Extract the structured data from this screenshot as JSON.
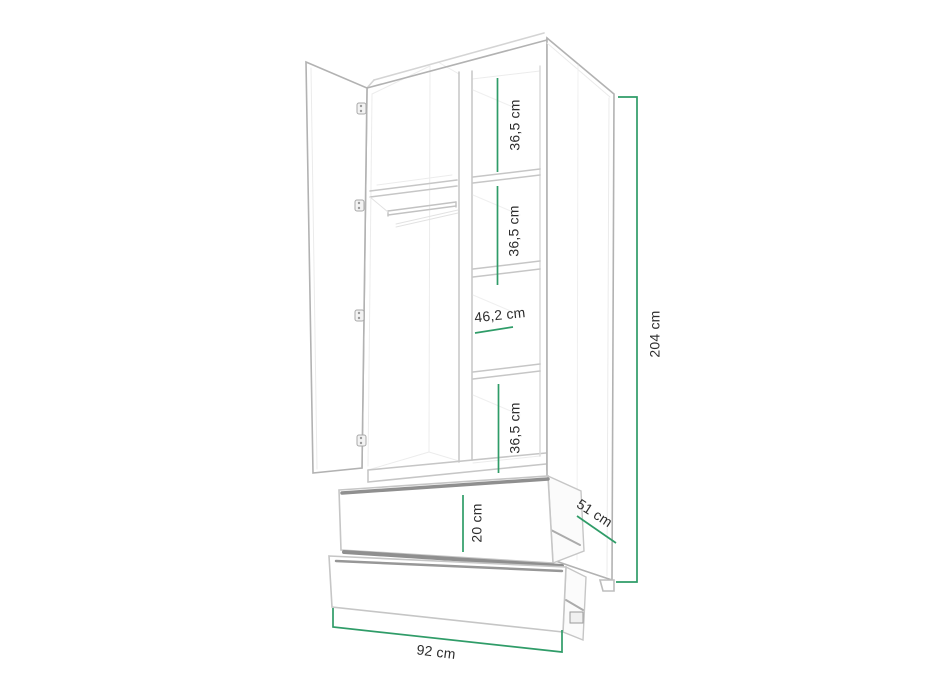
{
  "diagram": {
    "kind": "wardrobe-dimension-drawing",
    "labels": {
      "shelf1": "36,5 cm",
      "shelf2": "36,5 cm",
      "niche_width": "46,2 cm",
      "shelf4": "36,5 cm",
      "drawer_height": "20 cm",
      "depth": "51 cm",
      "total_height": "204 cm",
      "total_width": "92 cm"
    },
    "colors": {
      "dimension": "#2f9c68",
      "outline": "#c6c6c6",
      "outline_dark": "#b2b2b2",
      "faint": "#e9e9e9",
      "shadow_band": "#8f8f8f",
      "text": "#2d2d2d",
      "background": "#ffffff"
    }
  }
}
